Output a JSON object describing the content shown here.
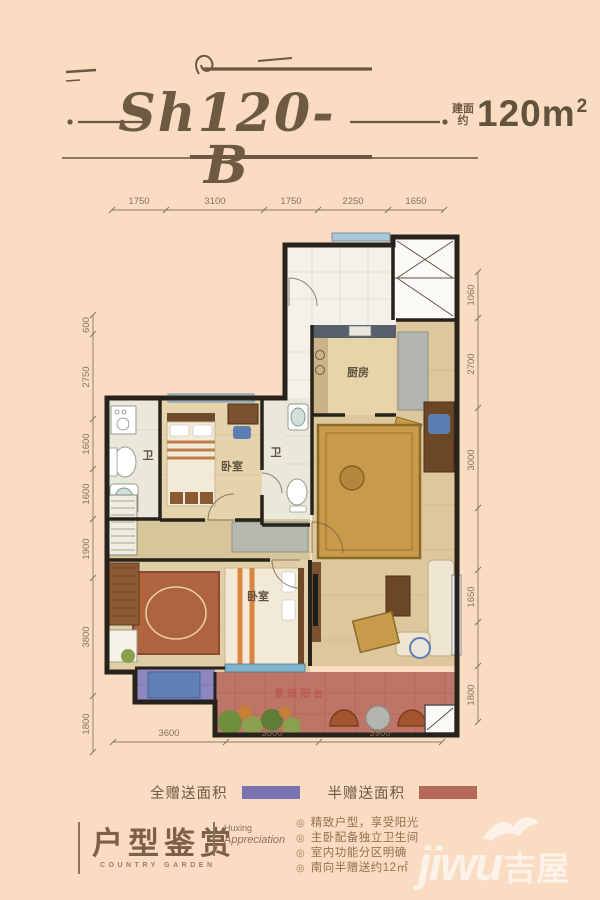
{
  "header": {
    "title": "Sh120-B",
    "area_label": "建面\n约",
    "area_value": "120m",
    "area_sup": "2"
  },
  "plan": {
    "dims_top": [
      "1750",
      "3100",
      "1750",
      "2250",
      "1650"
    ],
    "dims_left": [
      "600",
      "2750",
      "1600",
      "1600",
      "1900",
      "3800",
      "1800"
    ],
    "dims_right": [
      "1060",
      "2700",
      "3000",
      "1650",
      "1800"
    ],
    "dims_bottom": [
      "3600",
      "3000",
      "3900"
    ],
    "rooms": {
      "bath1": "卫",
      "bedroom1": "卧室",
      "bath2": "卫",
      "kitchen": "厨房",
      "bedroom2": "卧室",
      "terrace": "景观阳台"
    }
  },
  "legend": [
    {
      "label": "全赠送面积",
      "color": "#7b74b2"
    },
    {
      "label": "半赠送面积",
      "color": "#b5695a"
    }
  ],
  "footer": {
    "title_cn": "户型鉴赏",
    "subtitle_en": "COUNTRY GARDEN",
    "caption_line1": "Huxing",
    "caption_line2": "Appreciation",
    "bullet_icon": "◎",
    "bullets": [
      "精致户型，享受阳光",
      "主卧配备独立卫生间",
      "室内功能分区明确",
      "南向半赠送约12㎡"
    ]
  },
  "watermark": {
    "text_en": "jiwu",
    "text_cn": "吉屋"
  }
}
